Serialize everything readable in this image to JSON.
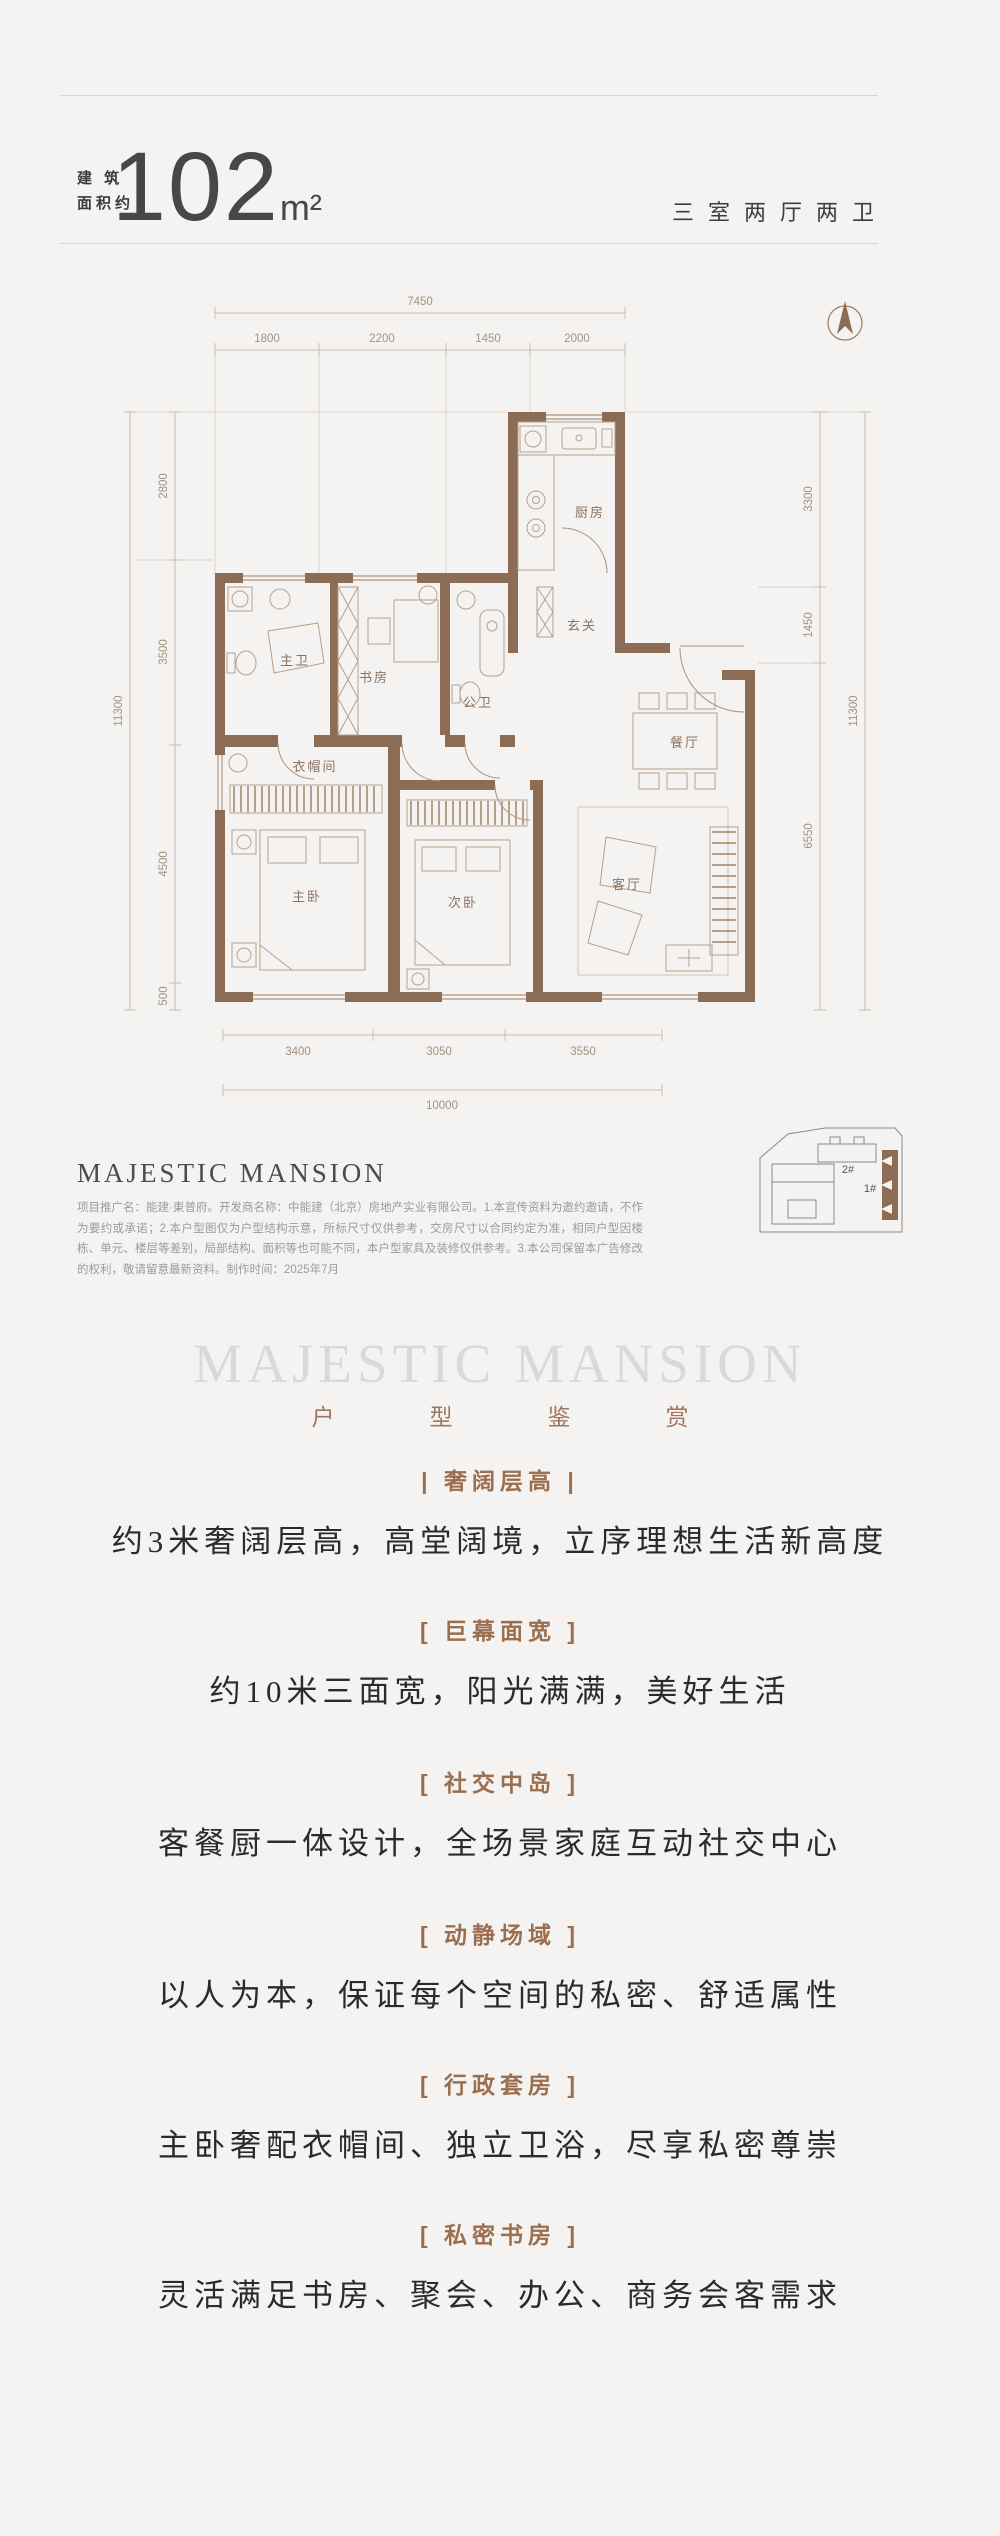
{
  "header": {
    "area_prefix_line1": "建 筑",
    "area_prefix_line2": "面积约",
    "area_value": "102",
    "area_unit": "m²",
    "layout_type": "三室两厅两卫"
  },
  "plan": {
    "wall_color": "#8d6c55",
    "dims": {
      "top_total": "7450",
      "top_segments": [
        "1800",
        "2200",
        "1450",
        "2000"
      ],
      "left_total": "11300",
      "left_segments": [
        "2800",
        "3500",
        "4500",
        "500"
      ],
      "right_total": "11300",
      "right_segments": [
        "3300",
        "1450",
        "6550"
      ],
      "bottom_total": "10000",
      "bottom_segments": [
        "3400",
        "3050",
        "3550"
      ]
    },
    "rooms": {
      "kitchen": "厨房",
      "entry": "玄关",
      "master_bath": "主卫",
      "study": "书房",
      "guest_bath": "公卫",
      "cloakroom": "衣帽间",
      "master_bedroom": "主卧",
      "second_bedroom": "次卧",
      "living": "客厅",
      "dining": "餐厅"
    }
  },
  "brand": {
    "name": "MAJESTIC MANSION",
    "disclaimer": "项目推广名：能建·東普府。开发商名称：中能建（北京）房地产实业有限公司。1.本宣传资料为邀约邀请，不作为要约或承诺；2.本户型图仅为户型结构示意，所标尺寸仅供参考，交房尺寸以合同约定为准，相同户型因楼栋、单元、楼层等差别，局部结构、面积等也可能不同，本户型家具及装修仅供参考。3.本公司保留本广告修改的权利，敬请留意最新资料。制作时间：2025年7月"
  },
  "site_map": {
    "building_1": "1#",
    "building_2": "2#"
  },
  "watermark": {
    "title": "MAJESTIC MANSION",
    "subtitle": "户型鉴赏"
  },
  "features": [
    {
      "tag": "| 奢阔层高 |",
      "desc": "约3米奢阔层高，高堂阔境，立序理想生活新高度"
    },
    {
      "tag": "[ 巨幕面宽 ]",
      "desc": "约10米三面宽，阳光满满，美好生活"
    },
    {
      "tag": "[ 社交中岛 ]",
      "desc": "客餐厨一体设计，全场景家庭互动社交中心"
    },
    {
      "tag": "[ 动静场域 ]",
      "desc": "以人为本，保证每个空间的私密、舒适属性"
    },
    {
      "tag": "[ 行政套房 ]",
      "desc": "主卧奢配衣帽间、独立卫浴，尽享私密尊崇"
    },
    {
      "tag": "[ 私密书房 ]",
      "desc": "灵活满足书房、聚会、办公、商务会客需求"
    }
  ]
}
